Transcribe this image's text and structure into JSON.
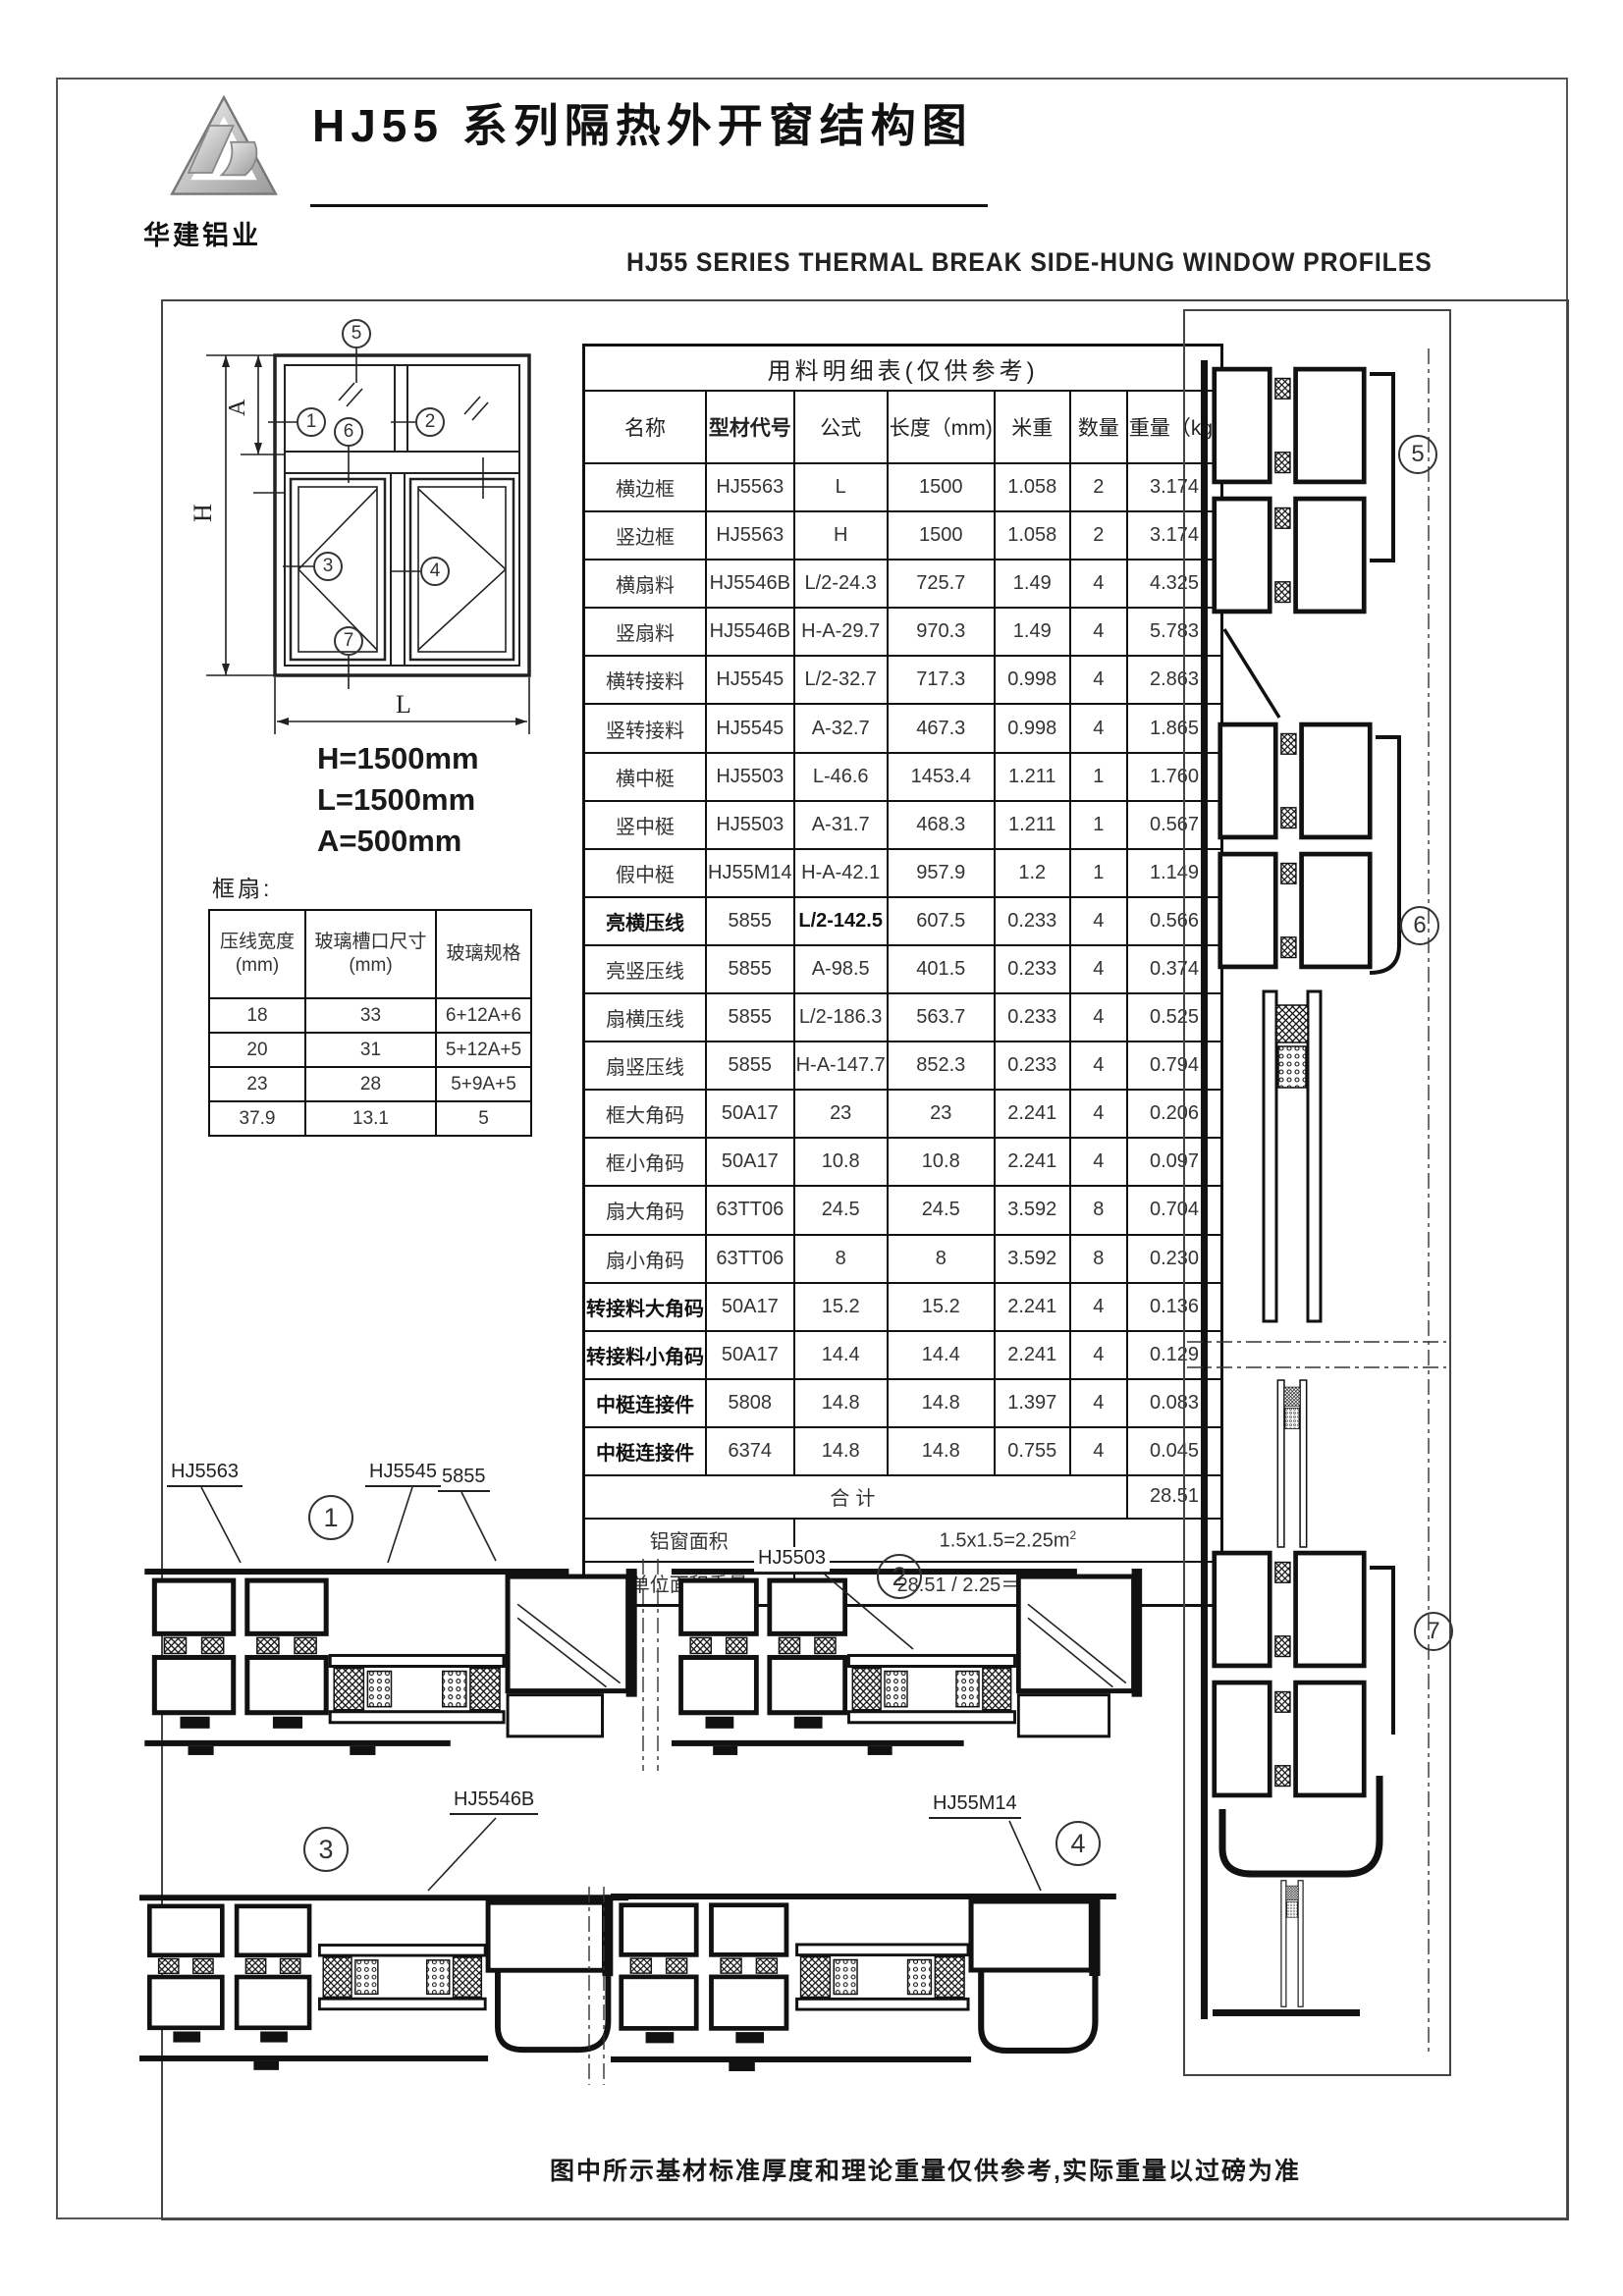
{
  "page": {
    "title": "HJ55 系列隔热外开窗结构图",
    "subtitle": "HJ55 SERIES THERMAL BREAK SIDE-HUNG WINDOW PROFILES",
    "logo_text": "华建铝业",
    "footer_note": "图中所示基材标准厚度和理论重量仅供参考,实际重量以过磅为准"
  },
  "window_diagram": {
    "markers": [
      "1",
      "2",
      "3",
      "4",
      "5",
      "6",
      "7"
    ],
    "dim_h": "H",
    "dim_a": "A",
    "dim_l": "L"
  },
  "dimensions": {
    "h": "H=1500mm",
    "l": "L=1500mm",
    "a": "A=500mm"
  },
  "frame_sash_heading": "框扇:",
  "glass_table": {
    "headers": [
      "压线宽度\n(mm)",
      "玻璃槽口尺寸\n(mm)",
      "玻璃规格"
    ],
    "rows": [
      [
        "18",
        "33",
        "6+12A+6"
      ],
      [
        "20",
        "31",
        "5+12A+5"
      ],
      [
        "23",
        "28",
        "5+9A+5"
      ],
      [
        "37.9",
        "13.1",
        "5"
      ]
    ]
  },
  "material_table": {
    "title": "用料明细表(仅供参考)",
    "headers": [
      "名称",
      "型材代号",
      "公式",
      "长度（mm)",
      "米重",
      "数量",
      "重量（kg)"
    ],
    "rows": [
      {
        "name": "横边框",
        "code": "HJ5563",
        "formula": "L",
        "length": "1500",
        "mweight": "1.058",
        "qty": "2",
        "weight": "3.174",
        "name_bold": false,
        "formula_bold": false
      },
      {
        "name": "竖边框",
        "code": "HJ5563",
        "formula": "H",
        "length": "1500",
        "mweight": "1.058",
        "qty": "2",
        "weight": "3.174",
        "name_bold": false,
        "formula_bold": false
      },
      {
        "name": "横扇料",
        "code": "HJ5546B",
        "formula": "L/2-24.3",
        "length": "725.7",
        "mweight": "1.49",
        "qty": "4",
        "weight": "4.325",
        "name_bold": false,
        "formula_bold": false
      },
      {
        "name": "竖扇料",
        "code": "HJ5546B",
        "formula": "H-A-29.7",
        "length": "970.3",
        "mweight": "1.49",
        "qty": "4",
        "weight": "5.783",
        "name_bold": false,
        "formula_bold": false
      },
      {
        "name": "横转接料",
        "code": "HJ5545",
        "formula": "L/2-32.7",
        "length": "717.3",
        "mweight": "0.998",
        "qty": "4",
        "weight": "2.863",
        "name_bold": false,
        "formula_bold": false
      },
      {
        "name": "竖转接料",
        "code": "HJ5545",
        "formula": "A-32.7",
        "length": "467.3",
        "mweight": "0.998",
        "qty": "4",
        "weight": "1.865",
        "name_bold": false,
        "formula_bold": false
      },
      {
        "name": "横中梃",
        "code": "HJ5503",
        "formula": "L-46.6",
        "length": "1453.4",
        "mweight": "1.211",
        "qty": "1",
        "weight": "1.760",
        "name_bold": false,
        "formula_bold": false
      },
      {
        "name": "竖中梃",
        "code": "HJ5503",
        "formula": "A-31.7",
        "length": "468.3",
        "mweight": "1.211",
        "qty": "1",
        "weight": "0.567",
        "name_bold": false,
        "formula_bold": false
      },
      {
        "name": "假中梃",
        "code": "HJ55M14",
        "formula": "H-A-42.1",
        "length": "957.9",
        "mweight": "1.2",
        "qty": "1",
        "weight": "1.149",
        "name_bold": false,
        "formula_bold": false
      },
      {
        "name": "亮横压线",
        "code": "5855",
        "formula": "L/2-142.5",
        "length": "607.5",
        "mweight": "0.233",
        "qty": "4",
        "weight": "0.566",
        "name_bold": true,
        "formula_bold": true
      },
      {
        "name": "亮竖压线",
        "code": "5855",
        "formula": "A-98.5",
        "length": "401.5",
        "mweight": "0.233",
        "qty": "4",
        "weight": "0.374",
        "name_bold": false,
        "formula_bold": false
      },
      {
        "name": "扇横压线",
        "code": "5855",
        "formula": "L/2-186.3",
        "length": "563.7",
        "mweight": "0.233",
        "qty": "4",
        "weight": "0.525",
        "name_bold": false,
        "formula_bold": false
      },
      {
        "name": "扇竖压线",
        "code": "5855",
        "formula": "H-A-147.7",
        "length": "852.3",
        "mweight": "0.233",
        "qty": "4",
        "weight": "0.794",
        "name_bold": false,
        "formula_bold": false
      },
      {
        "name": "框大角码",
        "code": "50A17",
        "formula": "23",
        "length": "23",
        "mweight": "2.241",
        "qty": "4",
        "weight": "0.206",
        "name_bold": false,
        "formula_bold": false
      },
      {
        "name": "框小角码",
        "code": "50A17",
        "formula": "10.8",
        "length": "10.8",
        "mweight": "2.241",
        "qty": "4",
        "weight": "0.097",
        "name_bold": false,
        "formula_bold": false
      },
      {
        "name": "扇大角码",
        "code": "63TT06",
        "formula": "24.5",
        "length": "24.5",
        "mweight": "3.592",
        "qty": "8",
        "weight": "0.704",
        "name_bold": false,
        "formula_bold": false
      },
      {
        "name": "扇小角码",
        "code": "63TT06",
        "formula": "8",
        "length": "8",
        "mweight": "3.592",
        "qty": "8",
        "weight": "0.230",
        "name_bold": false,
        "formula_bold": false
      },
      {
        "name": "转接料大角码",
        "code": "50A17",
        "formula": "15.2",
        "length": "15.2",
        "mweight": "2.241",
        "qty": "4",
        "weight": "0.136",
        "name_bold": true,
        "formula_bold": false
      },
      {
        "name": "转接料小角码",
        "code": "50A17",
        "formula": "14.4",
        "length": "14.4",
        "mweight": "2.241",
        "qty": "4",
        "weight": "0.129",
        "name_bold": true,
        "formula_bold": false
      },
      {
        "name": "中梃连接件",
        "code": "5808",
        "formula": "14.8",
        "length": "14.8",
        "mweight": "1.397",
        "qty": "4",
        "weight": "0.083",
        "name_bold": true,
        "formula_bold": false
      },
      {
        "name": "中梃连接件",
        "code": "6374",
        "formula": "14.8",
        "length": "14.8",
        "mweight": "0.755",
        "qty": "4",
        "weight": "0.045",
        "name_bold": true,
        "formula_bold": false
      }
    ],
    "total_label": "合计",
    "total_value": "28.51",
    "area_label": "铝窗面积",
    "area_value": "1.5x1.5=2.25m²",
    "unit_label": "单位面积重量",
    "unit_value": "28.51 / 2.25＝12.67kg/m²"
  },
  "annotations": {
    "label_hj5563": "HJ5563",
    "label_hj5545": "HJ5545",
    "label_5855": "5855",
    "label_hj5503": "HJ5503",
    "label_hj5546b": "HJ5546B",
    "label_hj55m14": "HJ55M14"
  }
}
